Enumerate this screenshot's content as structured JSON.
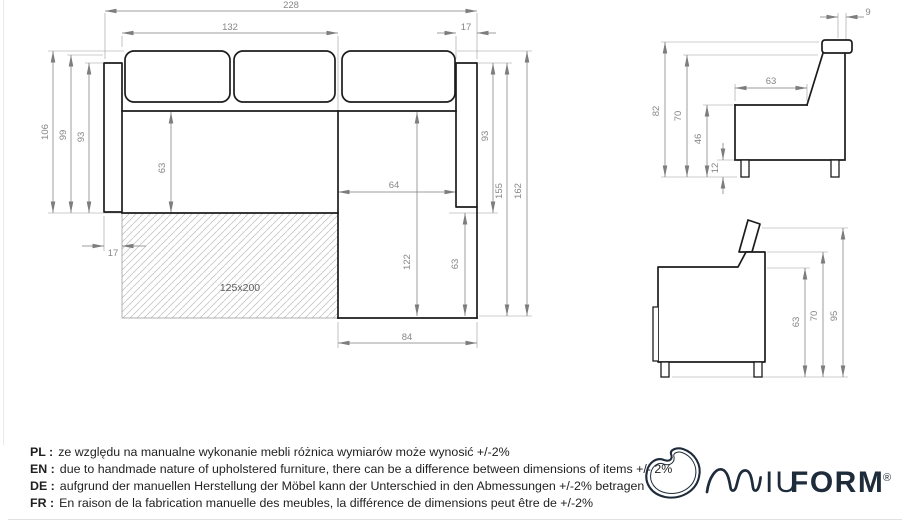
{
  "drawing": {
    "plan": {
      "total_width": "228",
      "seat_width": "132",
      "armrest_width_right": "17",
      "depth_with_cushions": "106",
      "depth_mid": "99",
      "depth_frame_left": "93",
      "seat_depth": "63",
      "armrest_width_left": "17",
      "chaise_inner_width": "64",
      "chaise_length": "122",
      "chaise_front_depth": "63",
      "chaise_width": "84",
      "depth_frame_right": "93",
      "length_to_armrest": "155",
      "total_length": "162",
      "bed_size": "125x200"
    },
    "side_back": {
      "headrest_depth": "9",
      "total_height": "82",
      "backrest_height": "70",
      "seat_height": "46",
      "leg_height": "12",
      "seat_depth": "63"
    },
    "side_front": {
      "armrest_height": "63",
      "backrest_height": "70",
      "total_height": "95"
    }
  },
  "disclaimer": {
    "rows": [
      {
        "label": "PL :",
        "text": "ze względu na manualne wykonanie mebli różnica wymiarów może wynosić +/-2%"
      },
      {
        "label": "EN :",
        "text": "due to handmade nature of upholstered furniture, there can be a difference between dimensions of items +/- 2%"
      },
      {
        "label": "DE :",
        "text": "aufgrund der manuellen Herstellung der Möbel kann der Unterschied in den Abmessungen +/-2% betragen"
      },
      {
        "label": "FR :",
        "text": "En raison de la fabrication manuelle des meubles, la différence de dimensions peut être de +/-2%"
      }
    ]
  },
  "logo": {
    "letters_light": "IU",
    "letters_bold": "FORM",
    "registered": "®",
    "brand_color": "#1d2b3a"
  }
}
